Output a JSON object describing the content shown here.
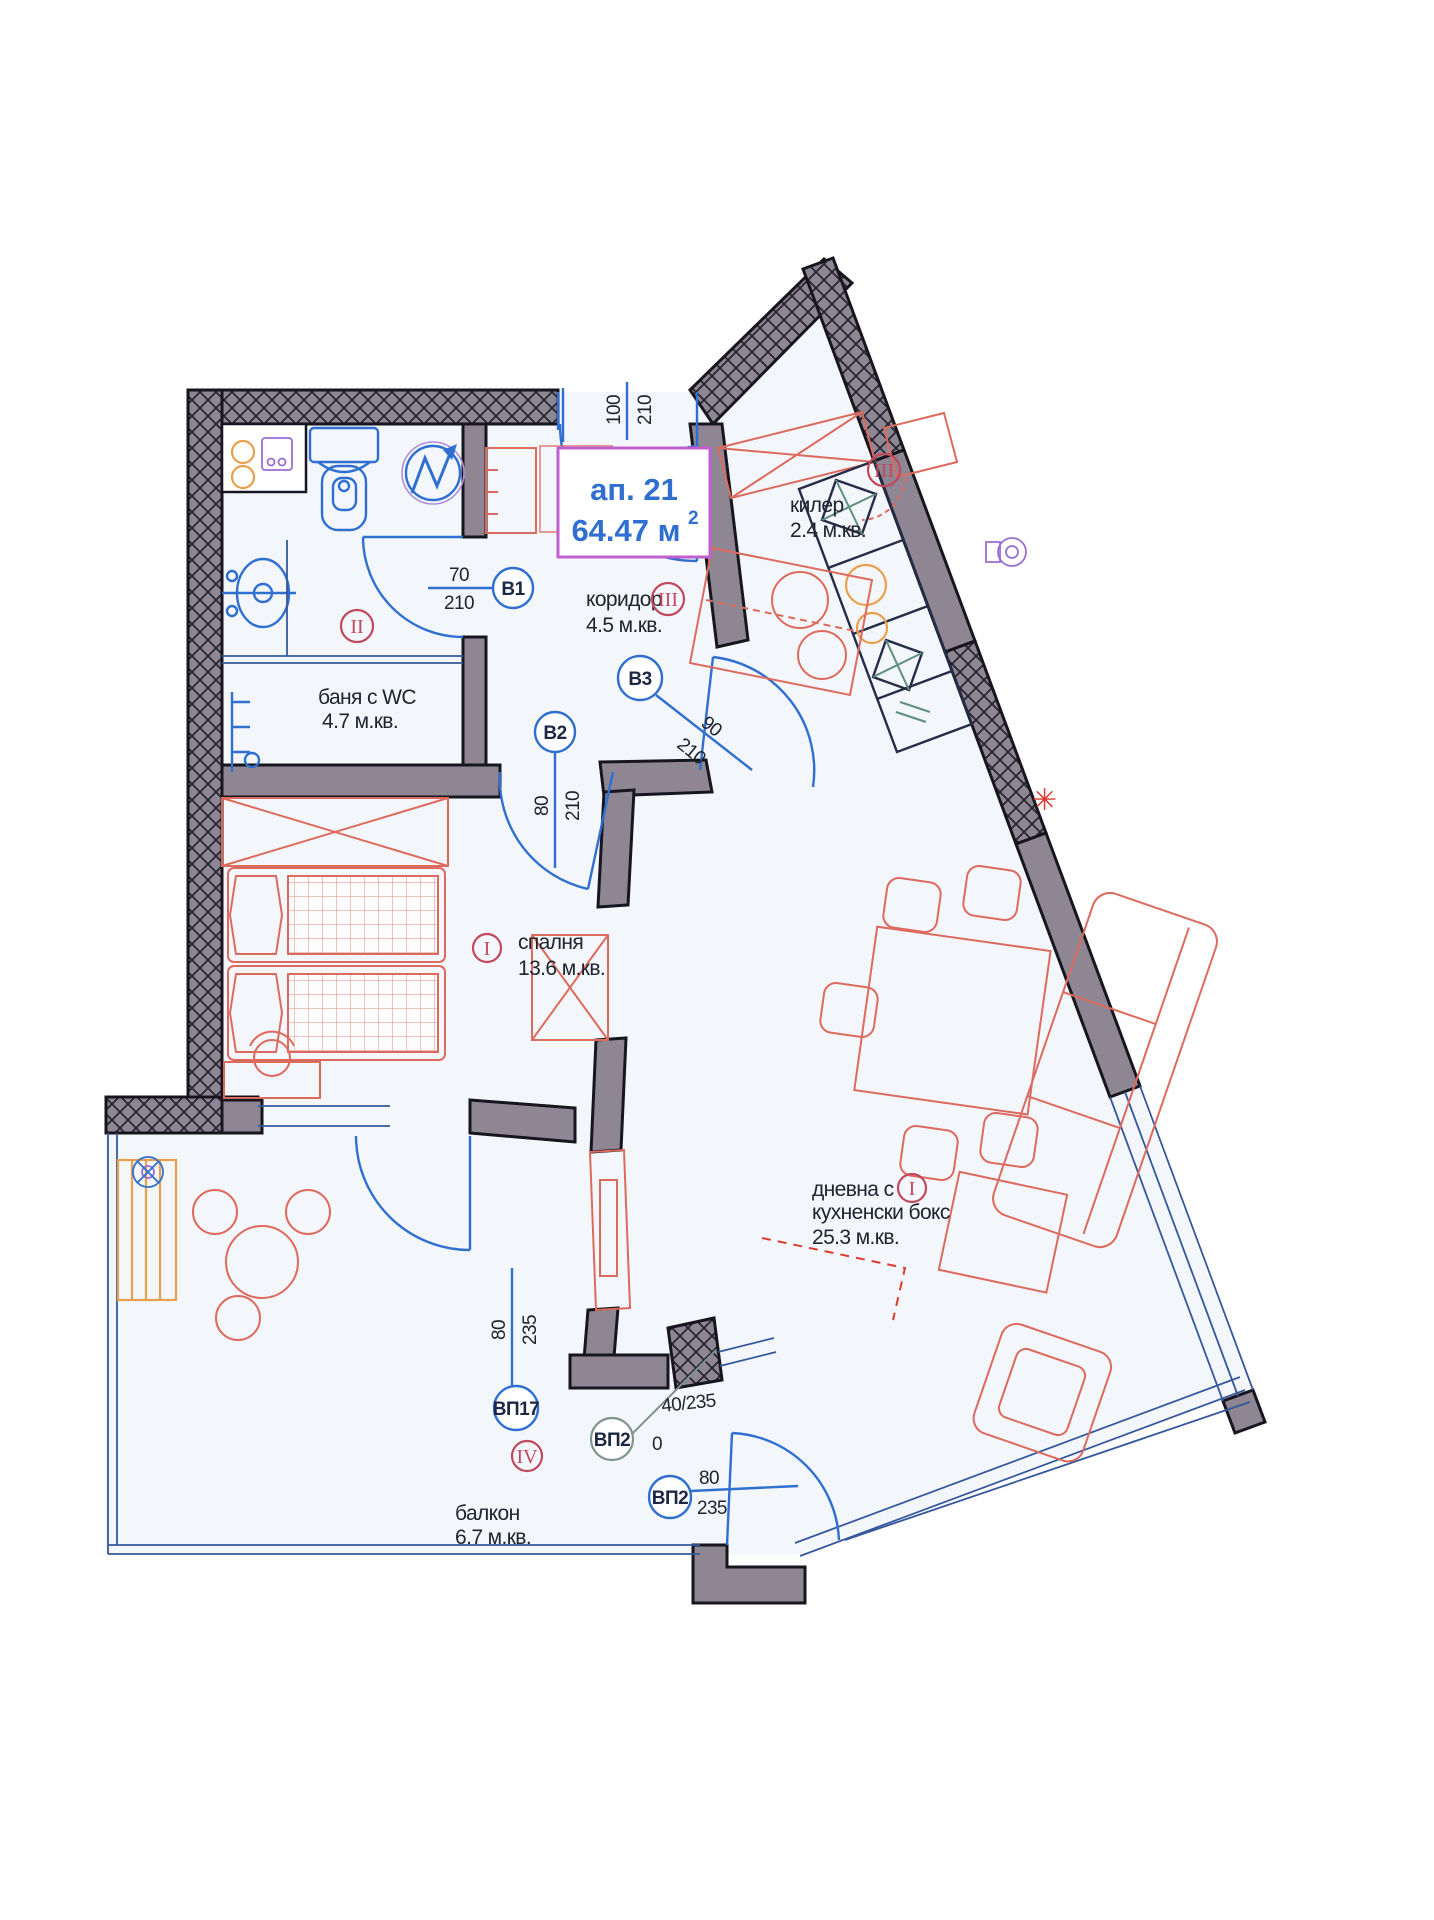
{
  "title_box": {
    "apartment_label": "ап. 21",
    "area_value": "64.47 м",
    "area_exponent": "2"
  },
  "rooms": {
    "bathroom": {
      "name": "баня с WC",
      "area": "4.7 м.кв.",
      "marker": "II"
    },
    "corridor": {
      "name": "коридор",
      "area": "4.5 м.кв.",
      "marker": "III"
    },
    "storage": {
      "name": "килер",
      "area": "2.4 м.кв.",
      "marker": "III"
    },
    "bedroom": {
      "name": "спалня",
      "area": "13.6 м.кв.",
      "marker": "I"
    },
    "living": {
      "name_line1": "дневна с",
      "name_line2": "кухненски бокс",
      "area": "25.3 м.кв.",
      "marker": "I"
    },
    "balcony": {
      "name": "балкон",
      "area": "6.7 м.кв.",
      "marker": "IV"
    }
  },
  "doors": {
    "entrance": {
      "width": "100",
      "height": "210"
    },
    "b1": {
      "label": "B1",
      "width": "70",
      "height": "210"
    },
    "b2": {
      "label": "B2",
      "width": "80",
      "height": "210"
    },
    "b3": {
      "label": "B3",
      "width": "90",
      "height": "210"
    },
    "vp17": {
      "label": "ВП17",
      "width": "80",
      "height": "235"
    },
    "vp2_fixed": {
      "label": "ВП2",
      "dim": "40/235",
      "extra": "0"
    },
    "vp2_door": {
      "label": "ВП2",
      "width": "80",
      "height": "235"
    }
  },
  "colors": {
    "wall_fill": "#8e8793",
    "wall_outline": "#17161f",
    "plan_blue": "#2f6fd0",
    "furniture_red": "#dd6a5e",
    "marker_red": "#c2485c",
    "title_border_magenta": "#c05fd0",
    "title_text_blue": "#2f6fd0",
    "teal": "#7d938c",
    "orange": "#e8a04c",
    "purple": "#9a6fd0",
    "room_fill": "#f3f6fa"
  }
}
